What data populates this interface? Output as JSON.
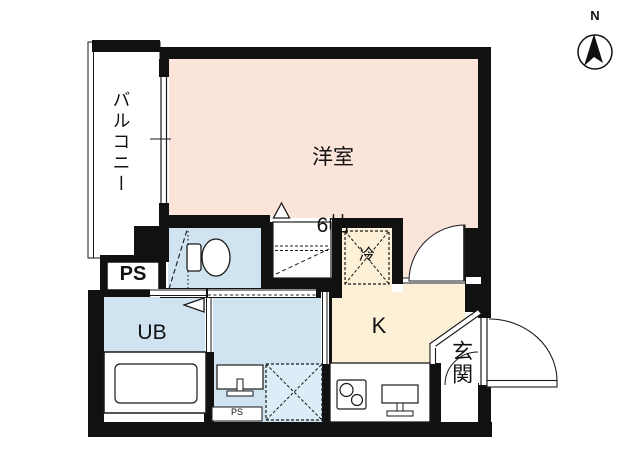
{
  "title": "apartment floor plan",
  "compass": {
    "north_label": "N"
  },
  "rooms": {
    "western": {
      "name": "洋室",
      "size": "6帖"
    },
    "balcony": {
      "name": "バルコニー"
    },
    "kitchen": {
      "name": "K"
    },
    "unit_bath": {
      "name": "UB"
    },
    "entrance": {
      "name": "玄関"
    },
    "refrigerator": {
      "name": "冷"
    },
    "pipe_space": {
      "name": "PS"
    },
    "pipe_space_2": {
      "name": "PS"
    }
  },
  "colors": {
    "room_pink": "#fbe4da",
    "water_blue": "#cfe3f0",
    "kitchen_cream": "#fcf0d6",
    "washer_blue": "#dcedf8",
    "wall": "#111111",
    "line": "#1a1a1a"
  }
}
